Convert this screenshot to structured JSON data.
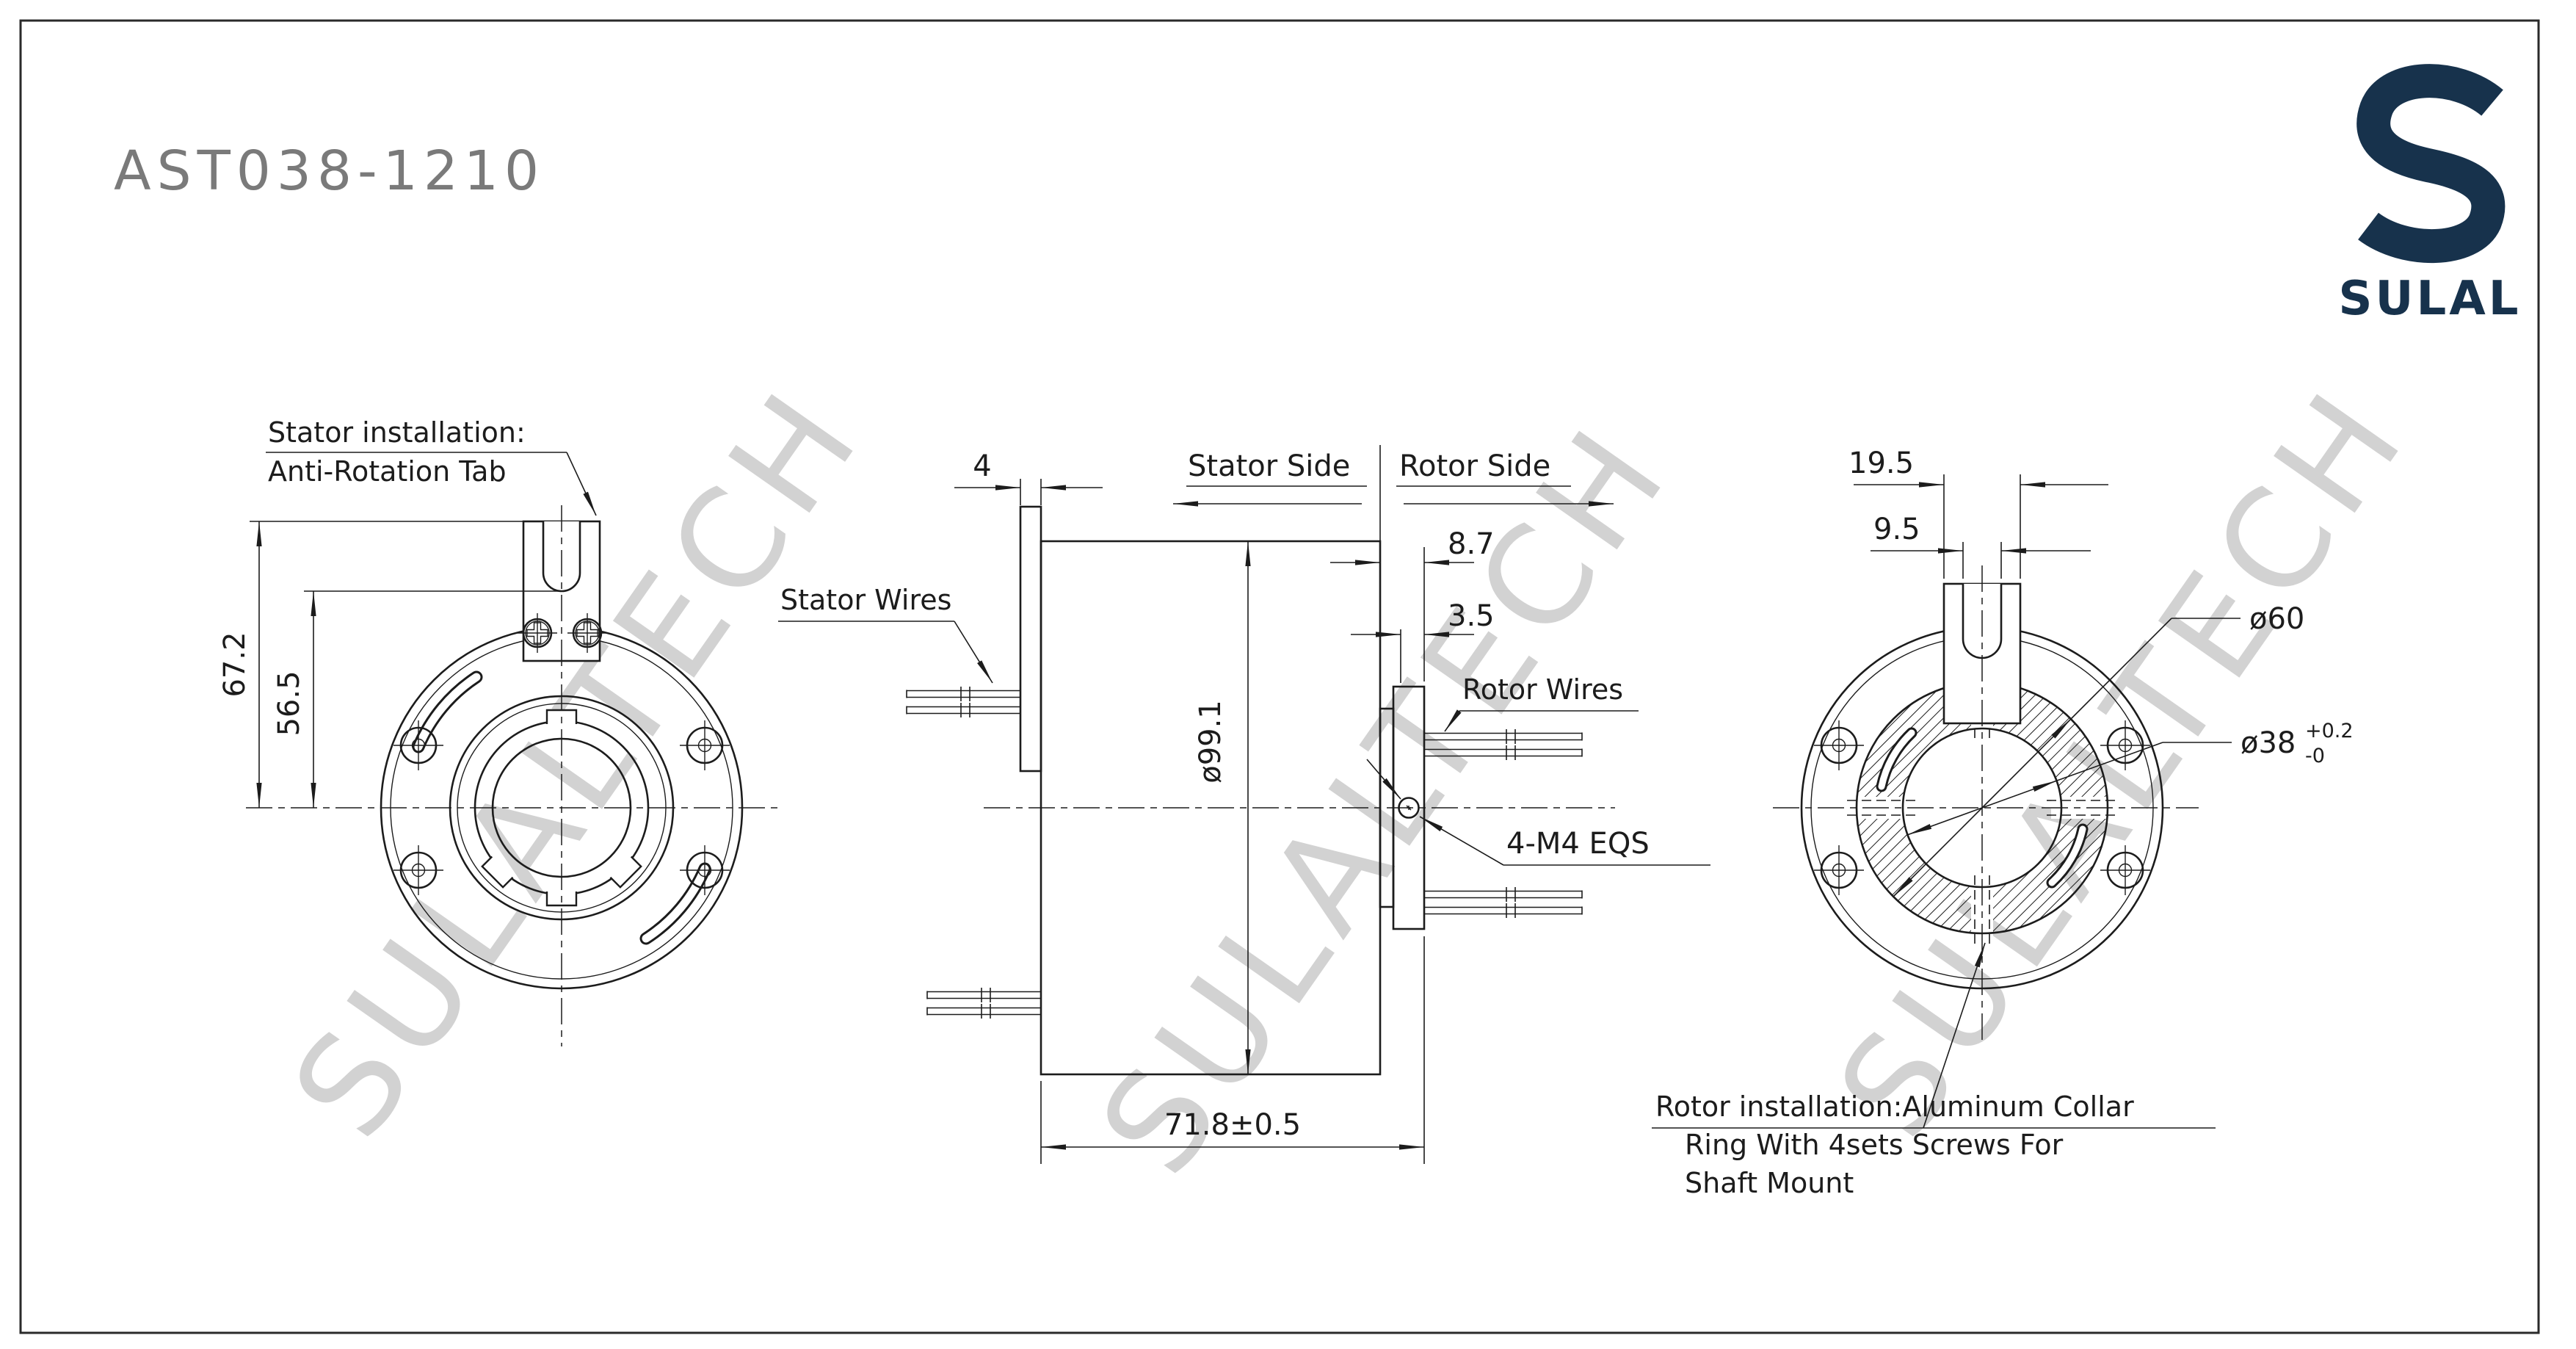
{
  "title": "AST038-1210",
  "brand": {
    "logo_text": "SULAL"
  },
  "watermark": {
    "text": "SULALTECH"
  },
  "colors": {
    "line": "#1c1c1c",
    "title_gray": "#7a7a7a",
    "brand_navy": "#17324c",
    "watermark_gray": "#d2d2d2",
    "background": "#ffffff"
  },
  "left_view": {
    "note_line1": "Stator installation:",
    "note_line2": "Anti-Rotation Tab",
    "dim_tab_height": "67.2",
    "dim_slot_height": "56.5"
  },
  "middle_view": {
    "dim_plate_thickness": "4",
    "stator_wires_label": "Stator Wires",
    "stator_side_label": "Stator Side",
    "rotor_side_label": "Rotor Side",
    "dim_rotor_overhang": "8.7",
    "dim_collar_thickness": "3.5",
    "rotor_wires_label": "Rotor Wires",
    "dim_body_diameter": "ø99.1",
    "screw_note": "4-M4 EQS",
    "dim_overall_length": "71.8±0.5"
  },
  "right_view": {
    "dim_tab_width": "19.5",
    "dim_slot_width": "9.5",
    "dim_outer_diameter": "ø60",
    "dim_bore_diameter": "ø38",
    "dim_bore_tol_plus": "+0.2",
    "dim_bore_tol_minus": "-0",
    "note_line1": "Rotor installation:Aluminum Collar",
    "note_line2": "Ring With 4sets Screws For",
    "note_line3": "Shaft Mount"
  }
}
